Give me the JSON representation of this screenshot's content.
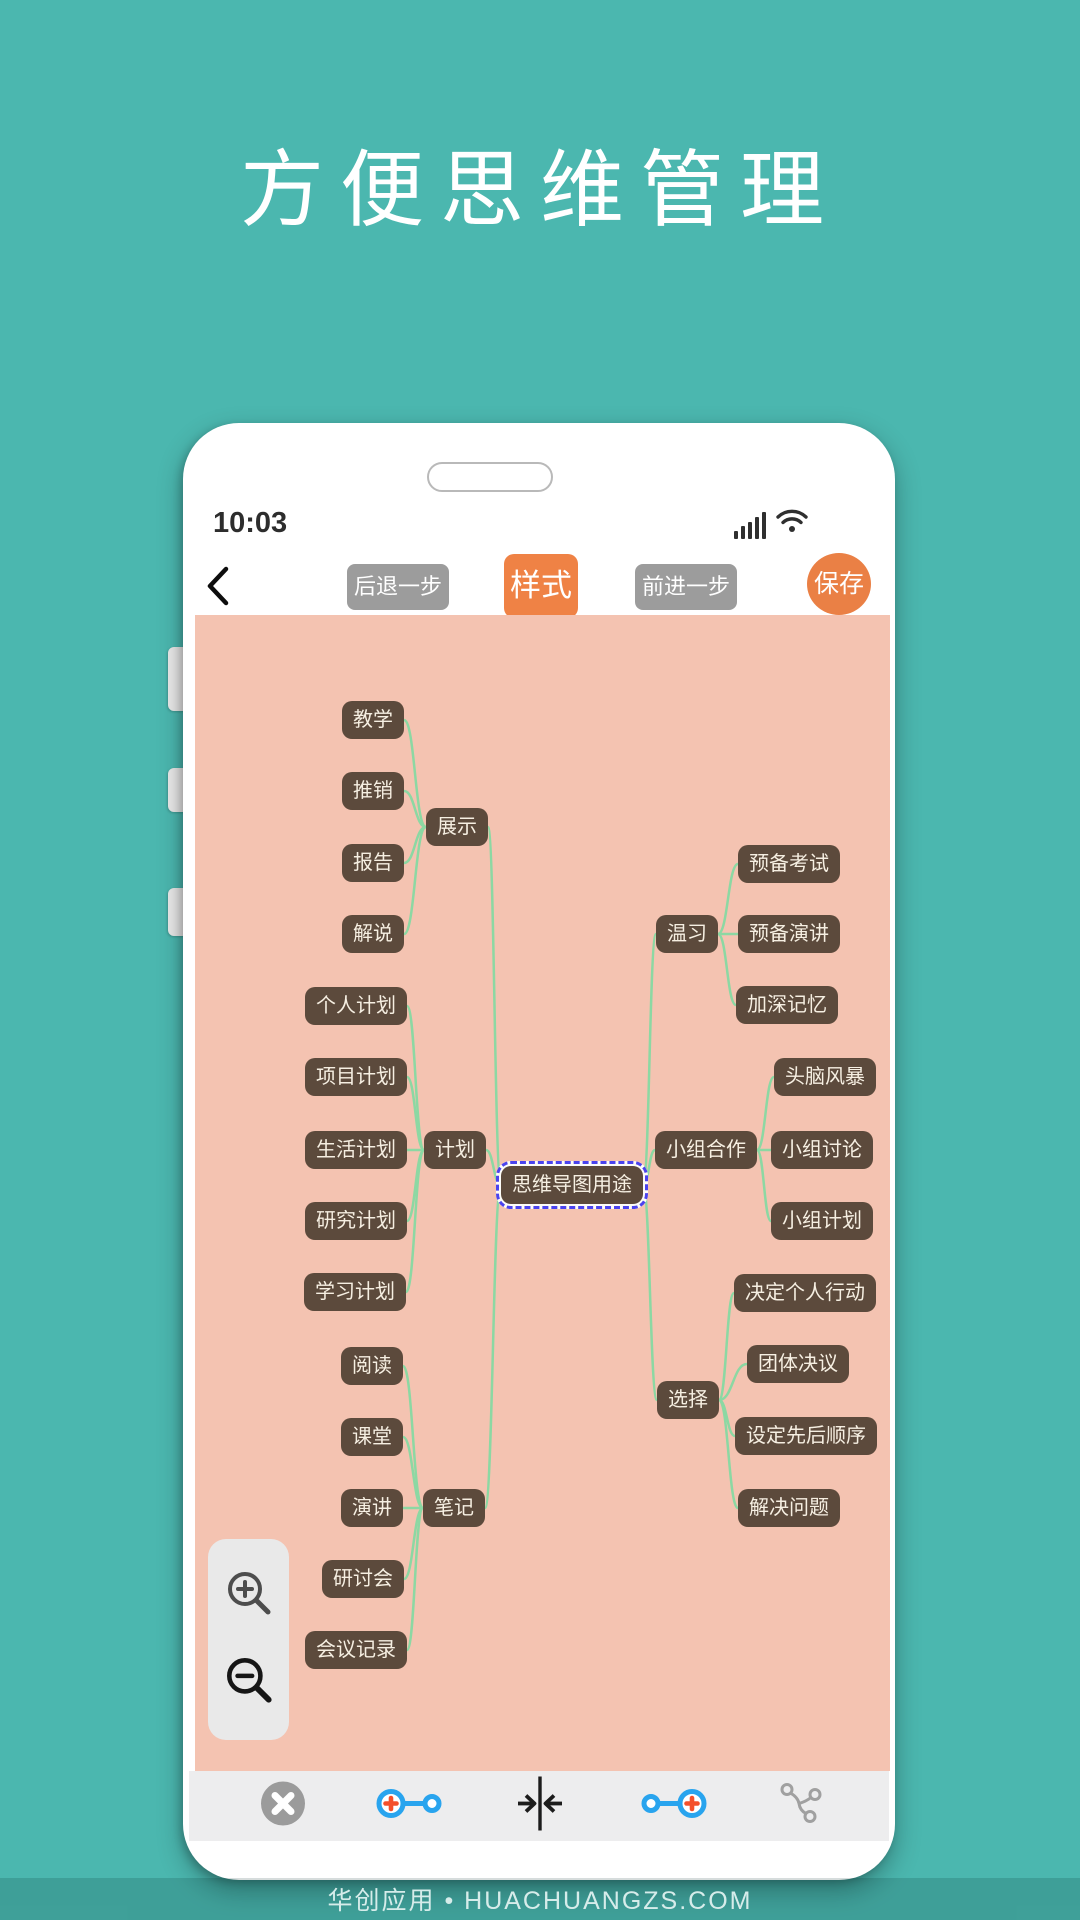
{
  "page": {
    "title": "方便思维管理",
    "footer": "华创应用 • HUACHUANGZS.COM"
  },
  "colors": {
    "background_teal": "#4bb7af",
    "canvas_pink": "#f4c3b1",
    "node_brown": "#5c4a3c",
    "node_text": "#f6efe2",
    "link_green": "#8cd8a3",
    "accent_orange": "#ef8245",
    "button_gray": "#9c9c9c",
    "selection_blue": "#4b43ee"
  },
  "status_bar": {
    "time": "10:03",
    "icons": [
      "signal-icon",
      "wifi-icon"
    ]
  },
  "toolbar": {
    "back_icon": "chevron-left-icon",
    "undo_label": "后退一步",
    "style_label": "样式",
    "redo_label": "前进一步",
    "save_label": "保存"
  },
  "canvas_controls": {
    "icons": [
      "zoom-in-icon",
      "zoom-out-icon"
    ]
  },
  "bottom_toolbar": {
    "icons": [
      "close-icon",
      "add-parent-node-icon",
      "collapse-node-icon",
      "add-child-node-icon",
      "tree-structure-icon"
    ]
  },
  "mindmap": {
    "nodes": [
      {
        "id": "center",
        "label": "思维导图用途",
        "x": 377,
        "y": 570,
        "parent": null,
        "selected": true
      },
      {
        "id": "zhanshi",
        "label": "展示",
        "x": 262,
        "y": 212,
        "parent": "center"
      },
      {
        "id": "jiaoxue",
        "label": "教学",
        "x": 178,
        "y": 105,
        "parent": "zhanshi"
      },
      {
        "id": "tuixiao",
        "label": "推销",
        "x": 178,
        "y": 176,
        "parent": "zhanshi"
      },
      {
        "id": "baogao",
        "label": "报告",
        "x": 178,
        "y": 248,
        "parent": "zhanshi"
      },
      {
        "id": "jieshuo",
        "label": "解说",
        "x": 178,
        "y": 319,
        "parent": "zhanshi"
      },
      {
        "id": "jihua",
        "label": "计划",
        "x": 260,
        "y": 535,
        "parent": "center"
      },
      {
        "id": "gerenjihua",
        "label": "个人计划",
        "x": 161,
        "y": 391,
        "parent": "jihua"
      },
      {
        "id": "xiangmujihua",
        "label": "项目计划",
        "x": 161,
        "y": 462,
        "parent": "jihua"
      },
      {
        "id": "shenghuojihua",
        "label": "生活计划",
        "x": 161,
        "y": 535,
        "parent": "jihua"
      },
      {
        "id": "yanjiujihua",
        "label": "研究计划",
        "x": 161,
        "y": 606,
        "parent": "jihua"
      },
      {
        "id": "xuexijihua",
        "label": "学习计划",
        "x": 160,
        "y": 677,
        "parent": "jihua"
      },
      {
        "id": "biji",
        "label": "笔记",
        "x": 259,
        "y": 893,
        "parent": "center"
      },
      {
        "id": "yuedu",
        "label": "阅读",
        "x": 177,
        "y": 751,
        "parent": "biji"
      },
      {
        "id": "ketang",
        "label": "课堂",
        "x": 177,
        "y": 822,
        "parent": "biji"
      },
      {
        "id": "yanjiang",
        "label": "演讲",
        "x": 177,
        "y": 893,
        "parent": "biji"
      },
      {
        "id": "yantaohui",
        "label": "研讨会",
        "x": 168,
        "y": 964,
        "parent": "biji"
      },
      {
        "id": "huiyijilu",
        "label": "会议记录",
        "x": 161,
        "y": 1035,
        "parent": "biji"
      },
      {
        "id": "wenxi",
        "label": "温习",
        "x": 492,
        "y": 319,
        "parent": "center"
      },
      {
        "id": "yubeikaoshi",
        "label": "预备考试",
        "x": 594,
        "y": 249,
        "parent": "wenxi"
      },
      {
        "id": "yubeiyanjiang",
        "label": "预备演讲",
        "x": 594,
        "y": 319,
        "parent": "wenxi"
      },
      {
        "id": "jiashenjiyi",
        "label": "加深记忆",
        "x": 592,
        "y": 390,
        "parent": "wenxi"
      },
      {
        "id": "xiaozuhezuo",
        "label": "小组合作",
        "x": 511,
        "y": 535,
        "parent": "center"
      },
      {
        "id": "tounaofengbao",
        "label": "头脑风暴",
        "x": 630,
        "y": 462,
        "parent": "xiaozuhezuo"
      },
      {
        "id": "xiaozutaolun",
        "label": "小组讨论",
        "x": 627,
        "y": 535,
        "parent": "xiaozuhezuo"
      },
      {
        "id": "xiaozujihua",
        "label": "小组计划",
        "x": 627,
        "y": 606,
        "parent": "xiaozuhezuo"
      },
      {
        "id": "xuanze",
        "label": "选择",
        "x": 493,
        "y": 785,
        "parent": "center"
      },
      {
        "id": "juedingxingdong",
        "label": "决定个人行动",
        "x": 610,
        "y": 678,
        "parent": "xuanze"
      },
      {
        "id": "tuantijueyi",
        "label": "团体决议",
        "x": 603,
        "y": 749,
        "parent": "xuanze"
      },
      {
        "id": "shedingshunxu",
        "label": "设定先后顺序",
        "x": 611,
        "y": 821,
        "parent": "xuanze"
      },
      {
        "id": "jiejuewenti",
        "label": "解决问题",
        "x": 594,
        "y": 893,
        "parent": "xuanze"
      }
    ]
  }
}
